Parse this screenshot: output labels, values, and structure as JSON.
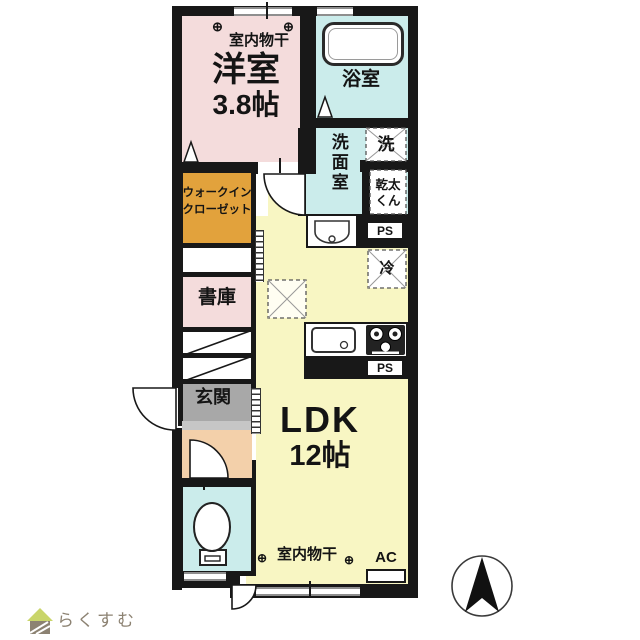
{
  "colors": {
    "wall": "#181818",
    "room_pink": "#f4dcdc",
    "room_cyan": "#cbeceb",
    "room_yellow": "#f8f6c3",
    "wic_orange": "#e2a23c",
    "entrance_gray": "#a8a8a8",
    "hall_peach": "#f3d0aa",
    "logo_color": "#8c8272",
    "logo_roof": "#c9d56a"
  },
  "rooms": {
    "western": {
      "name": "洋室",
      "size": "3.8帖"
    },
    "bath": {
      "name": "浴室"
    },
    "washroom": {
      "name": "洗面室"
    },
    "wic": {
      "line1": "ウォークイン",
      "line2": "クローゼット"
    },
    "library": {
      "name": "書庫"
    },
    "entrance": {
      "name": "玄関"
    },
    "ldk": {
      "name": "LDK",
      "size": "12帖"
    }
  },
  "fixtures": {
    "washer": "洗",
    "dryer_line1": "乾太",
    "dryer_line2": "くん",
    "fridge": "冷",
    "ps": "PS",
    "ps2": "PS",
    "ac": "AC",
    "laundry_top": "室内物干",
    "laundry_bottom": "室内物干",
    "hook": "⊕"
  },
  "branding": {
    "logo": "らくすむ"
  }
}
